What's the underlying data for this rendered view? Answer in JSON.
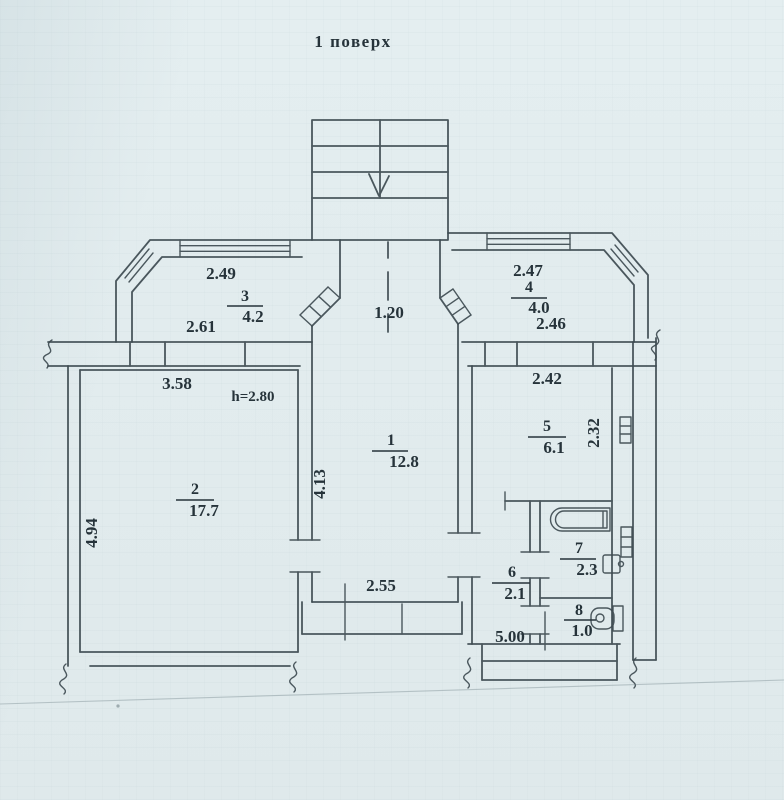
{
  "title": "1 поверх",
  "colors": {
    "paper": "#e2ecee",
    "ink": "#3e4b51",
    "text": "#26333a"
  },
  "rooms": {
    "r1": {
      "number": "1",
      "area": "12.8"
    },
    "r2": {
      "number": "2",
      "area": "17.7"
    },
    "r3": {
      "number": "3",
      "area": "4.2"
    },
    "r4": {
      "number": "4",
      "area": "4.0"
    },
    "r5": {
      "number": "5",
      "area": "6.1"
    },
    "r6": {
      "number": "6",
      "area": "2.1"
    },
    "r7": {
      "number": "7",
      "area": "2.3"
    },
    "r8": {
      "number": "8",
      "area": "1.0"
    }
  },
  "dimensions": {
    "left_wing_top": "2.49",
    "left_wing_bottom": "2.61",
    "passage_width": "1.20",
    "right_wing_top": "2.47",
    "right_wing_bottom": "2.46",
    "room2_top": "3.58",
    "ceiling_height": "h=2.80",
    "room2_left": "4.94",
    "room1_left": "4.13",
    "room1_bottom": "2.55",
    "room5_top": "2.42",
    "room5_right": "2.32",
    "bottom_right": "5.00"
  },
  "fixtures": {
    "bathtub": "bathtub",
    "toilet": "toilet",
    "sink": "sink",
    "radiator_upper": "radiator",
    "radiator_lower": "radiator"
  }
}
